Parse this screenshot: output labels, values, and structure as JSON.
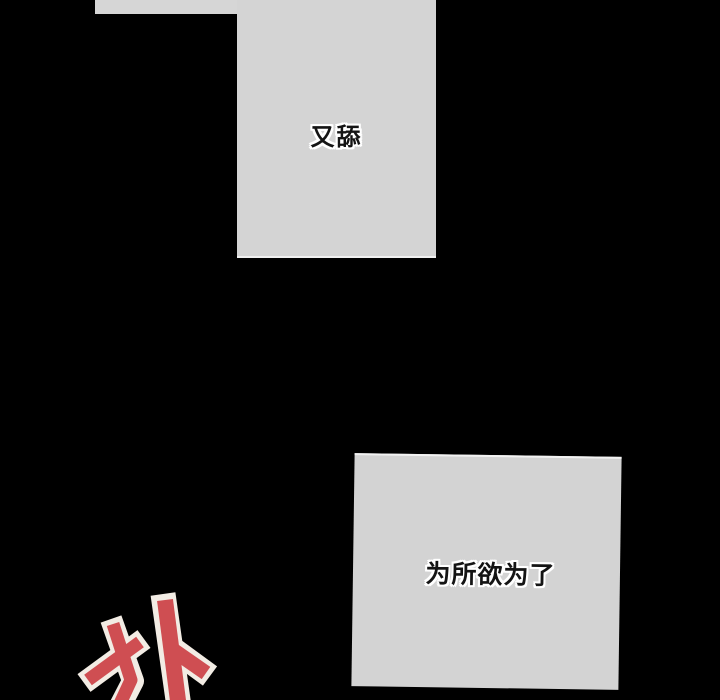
{
  "page": {
    "width": 720,
    "height": 700,
    "background": "#000000"
  },
  "panels": {
    "top_tab": {
      "bg": "#d6d6d6"
    },
    "top": {
      "text": "又舔",
      "bg": "#d4d4d4",
      "text_color": "#141414",
      "text_outline": "#ffffff"
    },
    "bottom": {
      "text": "为所欲为了",
      "bg": "#d3d3d3",
      "text_color": "#141414",
      "text_outline": "#ffffff"
    }
  },
  "sfx": {
    "text": "扑",
    "fill": "#cf4e52",
    "outline": "#f2ece4"
  }
}
